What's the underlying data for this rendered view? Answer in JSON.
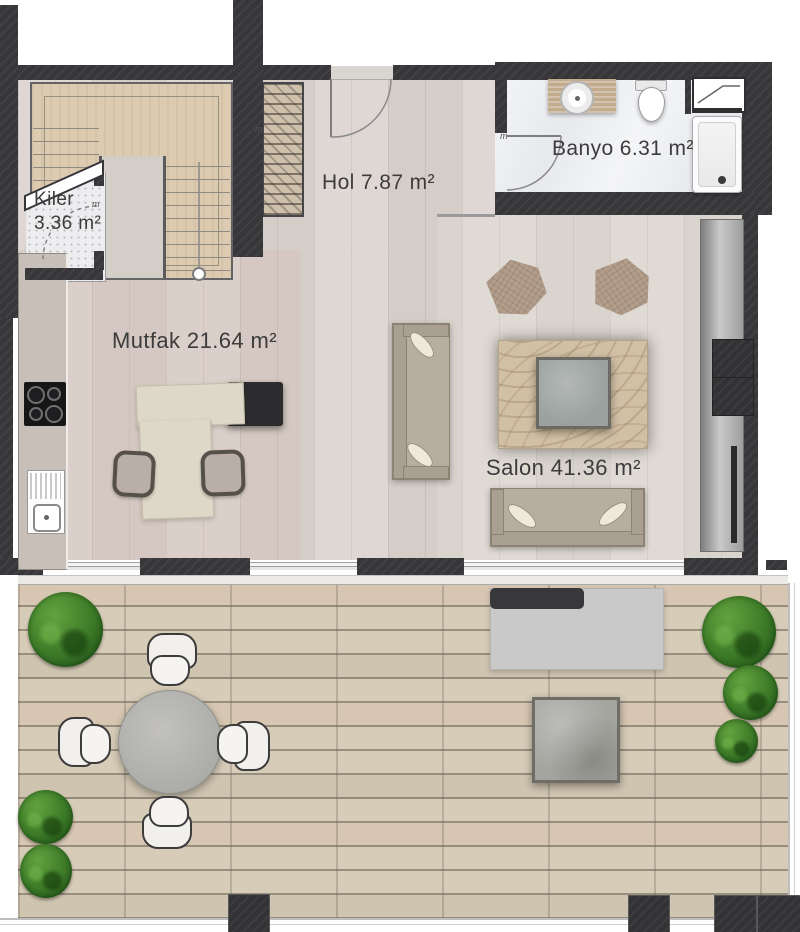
{
  "labels": {
    "kiler_name": "Kiler",
    "kiler_area": "3.36 m²",
    "hol": "Hol 7.87 m²",
    "banyo": "Banyo 6.31 m²",
    "mutfak": "Mutfak 21.64 m²",
    "salon": "Salon 41.36 m²",
    "door_marker": "m"
  },
  "rooms": [
    {
      "name": "Kiler",
      "area_m2": 3.36
    },
    {
      "name": "Hol",
      "area_m2": 7.87
    },
    {
      "name": "Banyo",
      "area_m2": 6.31
    },
    {
      "name": "Mutfak",
      "area_m2": 21.64
    },
    {
      "name": "Salon",
      "area_m2": 41.36
    }
  ],
  "colors": {
    "wall": "#37373a",
    "interior_floor": "#dad3ce",
    "stair_wood": "#ddcbb1",
    "bathroom_floor": "#eef0f3",
    "deck": "#d7ccb8",
    "plant_green": "#3f7d2b",
    "label_text": "#3c3c3c"
  }
}
